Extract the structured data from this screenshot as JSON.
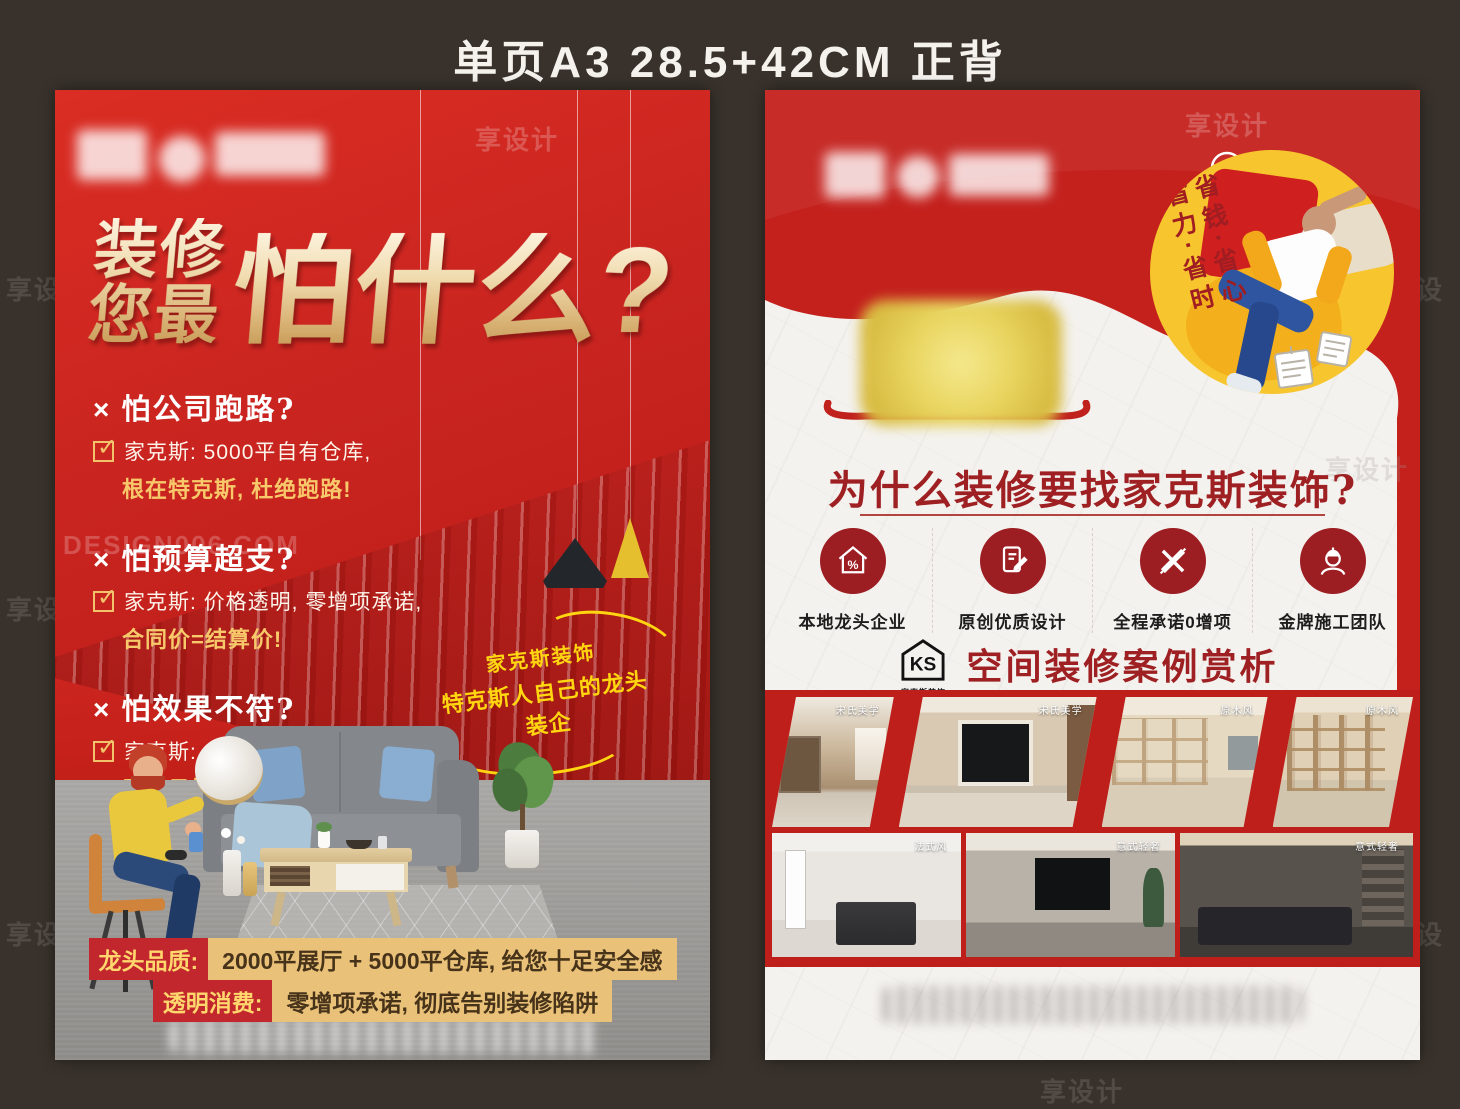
{
  "header": {
    "title": "单页A3   28.5+42CM  正背"
  },
  "watermark": {
    "brand": "享设计",
    "site": "DESIGN006.COM"
  },
  "marks": {
    "cross": "×",
    "check": "✓"
  },
  "colors": {
    "poster_red": "#c4211d",
    "gold_text": "#e7c884",
    "badge_yellow": "#f7c52e",
    "dark_red": "#9e2023",
    "banner_tan": "#e9c179",
    "banner_red": "#c1272d",
    "background_dark": "#39322c"
  },
  "front": {
    "title_line1": "装修",
    "title_line2": "您最",
    "title_big": "怕什么?",
    "fears": [
      {
        "q": "怕公司跑路?",
        "a1": "家克斯: 5000平自有仓库,",
        "a2": "根在特克斯, 杜绝跑路!"
      },
      {
        "q": "怕预算超支?",
        "a1": "家克斯: 价格透明, 零增项承诺,",
        "a2": "合同价=结算价!"
      },
      {
        "q": "怕效果不符?",
        "a1": "家克斯: 2000平实景展厅,",
        "a2": "看得见摸得着的品质!"
      }
    ],
    "badge_line1": "家克斯装饰",
    "badge_line2": "特克斯人自己的龙头装企",
    "banner1_label": "龙头品质:",
    "banner1_text": "2000平展厅 + 5000平仓库, 给您十足安全感",
    "banner2_label": "透明消费:",
    "banner2_text": "零增项承诺, 彻底告别装修陷阱"
  },
  "back": {
    "circle_badge": {
      "line1": "省钱·省心",
      "line2": "省力·省时"
    },
    "title": "为什么装修要找家克斯装饰?",
    "features": [
      {
        "icon": "house-percent-icon",
        "label": "本地龙头企业"
      },
      {
        "icon": "design-doc-icon",
        "label": "原创优质设计"
      },
      {
        "icon": "crossed-tools-icon",
        "label": "全程承诺0增项"
      },
      {
        "icon": "builder-icon",
        "label": "金牌施工团队"
      }
    ],
    "logo": {
      "text": "KS",
      "subtext": "家克斯装饰"
    },
    "cases_title": "空间装修案例赏析",
    "case_photos_row1": [
      {
        "label": "宋氏美学"
      },
      {
        "label": "宋氏美学"
      },
      {
        "label": "原木风"
      },
      {
        "label": "原木风"
      }
    ],
    "case_photos_row2": [
      {
        "label": "法式风"
      },
      {
        "label": "意式轻奢"
      },
      {
        "label": "意式轻奢"
      }
    ]
  }
}
